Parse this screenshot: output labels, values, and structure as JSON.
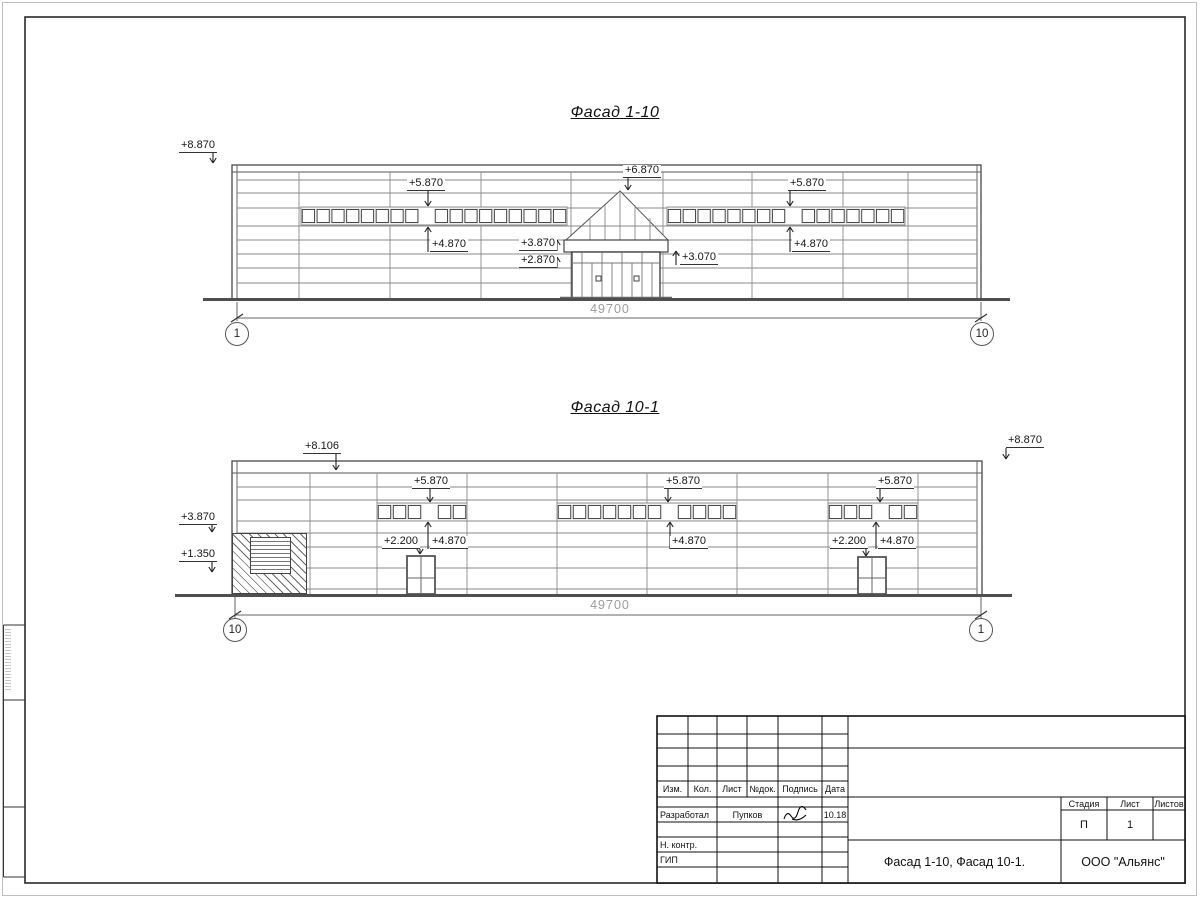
{
  "sheet": {
    "accent_line_color": "#2a2a2a",
    "dim_text_color": "#9c9c9c"
  },
  "fa": {
    "title": "Фасад 1-10",
    "dim": "49700",
    "axis_left": "1",
    "axis_right": "10",
    "marks": {
      "parapet_left": "+8.870",
      "strip_left_top": "+5.870",
      "strip_left_bottom": "+4.870",
      "ridge": "+6.870",
      "strip_right_top": "+5.870",
      "strip_right_bottom": "+4.870",
      "canopy_top": "+3.870",
      "entry_top": "+2.870",
      "canopy_edge": "+3.070"
    }
  },
  "fb": {
    "title": "Фасад 10-1",
    "dim": "49700",
    "axis_left": "10",
    "axis_right": "1",
    "marks": {
      "parapet_mid": "+8.106",
      "parapet_right": "+8.870",
      "wall_upper": "+3.870",
      "wall_lower": "+1.350",
      "s1_top": "+5.870",
      "s1_bottom": "+4.870",
      "door1": "+2.200",
      "s2_top": "+5.870",
      "s2_bottom": "+4.870",
      "s3_top": "+5.870",
      "door2": "+2.200",
      "s3_bottom": "+4.870"
    }
  },
  "tb": {
    "izm": "Изм.",
    "kol": "Кол.",
    "list": "Лист",
    "ndok": "№док.",
    "podpis": "Подпись",
    "data": "Дата",
    "row1_role": "Разработал",
    "row1_name": "Пупков",
    "row1_date": "10.18",
    "row2_role": "Н. контр.",
    "row3_role": "ГИП",
    "stage_h": "Стадия",
    "sheet_h": "Лист",
    "sheets_h": "Листов",
    "stage_v": "П",
    "sheet_v": "1",
    "doc_title": "Фасад 1-10, Фасад 10-1.",
    "company": "ООО \"Альянс\""
  }
}
